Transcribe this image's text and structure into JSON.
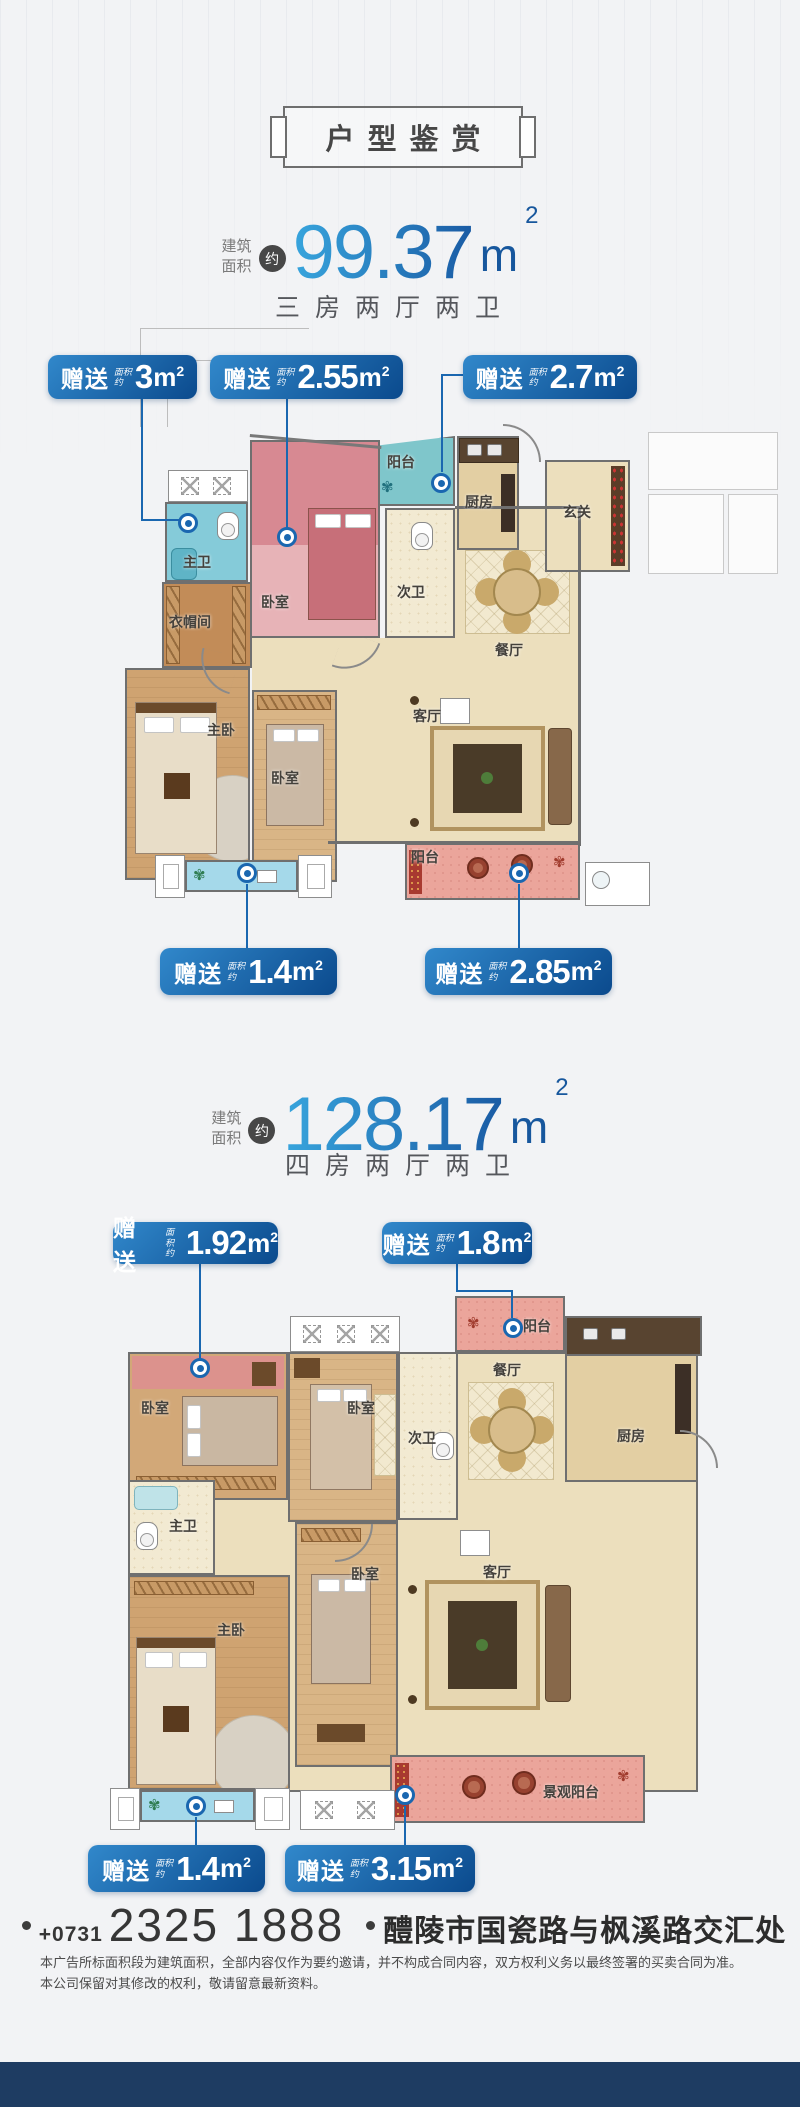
{
  "header": {
    "title": "户型鉴赏"
  },
  "units": [
    {
      "area_l1": "建筑",
      "area_l2": "面积",
      "approx": "约",
      "area_value": "99.37",
      "area_unit": "m",
      "area_sq": "2",
      "layout": "三房两厅两卫",
      "badges": [
        {
          "label": "赠送",
          "sub1": "面积",
          "sub2": "约",
          "value": "3",
          "unit": "m",
          "sq": "2"
        },
        {
          "label": "赠送",
          "sub1": "面积",
          "sub2": "约",
          "value": "2.55",
          "unit": "m",
          "sq": "2"
        },
        {
          "label": "赠送",
          "sub1": "面积",
          "sub2": "约",
          "value": "2.7",
          "unit": "m",
          "sq": "2"
        },
        {
          "label": "赠送",
          "sub1": "面积",
          "sub2": "约",
          "value": "1.4",
          "unit": "m",
          "sq": "2"
        },
        {
          "label": "赠送",
          "sub1": "面积",
          "sub2": "约",
          "value": "2.85",
          "unit": "m",
          "sq": "2"
        }
      ],
      "rooms": {
        "balcony_top": "阳台",
        "kitchen": "厨房",
        "entry": "玄关",
        "master_bath": "主卫",
        "bedroom1": "卧室",
        "bath2": "次卫",
        "closet": "衣帽间",
        "dining": "餐厅",
        "living": "客厅",
        "master_bedroom": "主卧",
        "bedroom2": "卧室",
        "balcony_bottom": "阳台"
      }
    },
    {
      "area_l1": "建筑",
      "area_l2": "面积",
      "approx": "约",
      "area_value": "128.17",
      "area_unit": "m",
      "area_sq": "2",
      "layout": "四房两厅两卫",
      "badges": [
        {
          "label": "赠送",
          "sub1": "面积",
          "sub2": "约",
          "value": "1.92",
          "unit": "m",
          "sq": "2"
        },
        {
          "label": "赠送",
          "sub1": "面积",
          "sub2": "约",
          "value": "1.8",
          "unit": "m",
          "sq": "2"
        },
        {
          "label": "赠送",
          "sub1": "面积",
          "sub2": "约",
          "value": "1.4",
          "unit": "m",
          "sq": "2"
        },
        {
          "label": "赠送",
          "sub1": "面积",
          "sub2": "约",
          "value": "3.15",
          "unit": "m",
          "sq": "2"
        }
      ],
      "rooms": {
        "balcony_top": "阳台",
        "bedroom1": "卧室",
        "bedroom2": "卧室",
        "bath2": "次卫",
        "dining": "餐厅",
        "kitchen": "厨房",
        "master_bath": "主卫",
        "master_bedroom": "主卧",
        "bedroom3": "卧室",
        "living": "客厅",
        "view_balcony": "景观阳台"
      }
    }
  ],
  "footer": {
    "phone_prefix": "+0731",
    "phone": "2325 1888",
    "address": "醴陵市国瓷路与枫溪路交汇处",
    "disclaimer1": "本广告所标面积段为建筑面积，全部内容仅作为要约邀请，并不构成合同内容，双方权利义务以最终签署的买卖合同为准。",
    "disclaimer2": "本公司保留对其修改的权利，敬请留意最新资料。"
  },
  "colors": {
    "badge_blue": "#0b4a8d",
    "accent_blue": "#1a67b0",
    "navy_bar": "#1e3c62"
  }
}
